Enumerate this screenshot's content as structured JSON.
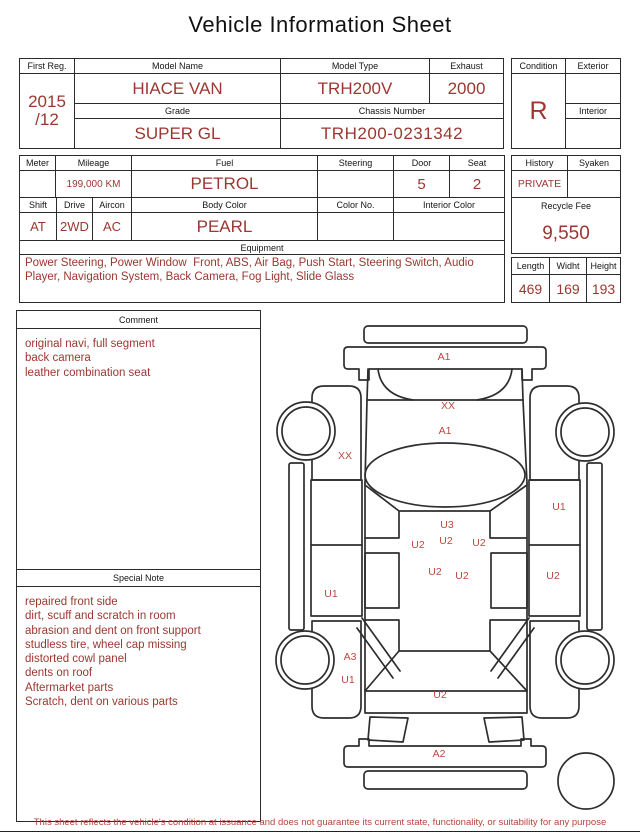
{
  "title": "Vehicle Information Sheet",
  "table1": {
    "first_reg_label": "First Reg.",
    "first_reg_value": [
      "2015",
      "/12"
    ],
    "model_name_label": "Model Name",
    "model_name_value": "HIACE VAN",
    "model_type_label": "Model Type",
    "model_type_value": "TRH200V",
    "exhaust_label": "Exhaust",
    "exhaust_value": "2000",
    "grade_label": "Grade",
    "grade_value": "SUPER GL",
    "chassis_label": "Chassis Number",
    "chassis_value": "TRH200-0231342",
    "condition_label": "Condition",
    "condition_value": "R",
    "exterior_label": "Exterior",
    "exterior_value": "",
    "interior_label": "Interior",
    "interior_value": ""
  },
  "table2": {
    "meter_label": "Meter",
    "meter_value": "",
    "mileage_label": "Mileage",
    "mileage_value": "199,000 KM",
    "fuel_label": "Fuel",
    "fuel_value": "PETROL",
    "steering_label": "Steering",
    "steering_value": "",
    "door_label": "Door",
    "door_value": "5",
    "seat_label": "Seat",
    "seat_value": "2",
    "shift_label": "Shift",
    "shift_value": "AT",
    "drive_label": "Drive",
    "drive_value": "2WD",
    "aircon_label": "Aircon",
    "aircon_value": "AC",
    "body_color_label": "Body Color",
    "body_color_value": "PEARL",
    "color_no_label": "Color No.",
    "color_no_value": "",
    "interior_color_label": "Interior Color",
    "interior_color_value": "",
    "equipment_label": "Equipment",
    "equipment_value": "Power Steering, Power Window  Front, ABS, Air Bag, Push Start, Steering Switch, Audio Player, Navigation System, Back Camera, Fog Light, Slide Glass",
    "history_label": "History",
    "history_value": "PRIVATE",
    "syaken_label": "Syaken",
    "syaken_value": "",
    "recycle_fee_label": "Recycle Fee",
    "recycle_fee_value": "9,550",
    "length_label": "Length",
    "length_value": "469",
    "width_label": "Widht",
    "width_value": "169",
    "height_label": "Height",
    "height_value": "193"
  },
  "comment": {
    "label": "Comment",
    "lines": [
      "original navi, full segment",
      "back camera",
      "leather combination seat"
    ]
  },
  "special_note": {
    "label": "Special Note",
    "lines": [
      "repaired front side",
      "dirt, scuff and scratch in room",
      "abrasion and dent on front support",
      "studless tire, wheel cap missing",
      "distorted cowl panel",
      "dents on roof",
      "Aftermarket parts",
      "Scratch, dent on various parts"
    ]
  },
  "diagram": {
    "labels": [
      {
        "code": "A1",
        "x": 179,
        "y": 47
      },
      {
        "code": "XX",
        "x": 183,
        "y": 96
      },
      {
        "code": "A1",
        "x": 180,
        "y": 121
      },
      {
        "code": "XX",
        "x": 80,
        "y": 146
      },
      {
        "code": "U1",
        "x": 294,
        "y": 197
      },
      {
        "code": "U3",
        "x": 182,
        "y": 215
      },
      {
        "code": "U2",
        "x": 153,
        "y": 235
      },
      {
        "code": "U2",
        "x": 181,
        "y": 231
      },
      {
        "code": "U2",
        "x": 214,
        "y": 233
      },
      {
        "code": "U2",
        "x": 170,
        "y": 262
      },
      {
        "code": "U2",
        "x": 197,
        "y": 266
      },
      {
        "code": "U2",
        "x": 288,
        "y": 266
      },
      {
        "code": "U1",
        "x": 66,
        "y": 284
      },
      {
        "code": "A3",
        "x": 85,
        "y": 347
      },
      {
        "code": "U1",
        "x": 83,
        "y": 370
      },
      {
        "code": "U2",
        "x": 175,
        "y": 385
      },
      {
        "code": "A2",
        "x": 174,
        "y": 444
      }
    ]
  },
  "footer": {
    "disclaimer": "This sheet reflects the vehicle's condition at issuance and does not guarantee its current state, functionality, or suitability for any purpose"
  }
}
